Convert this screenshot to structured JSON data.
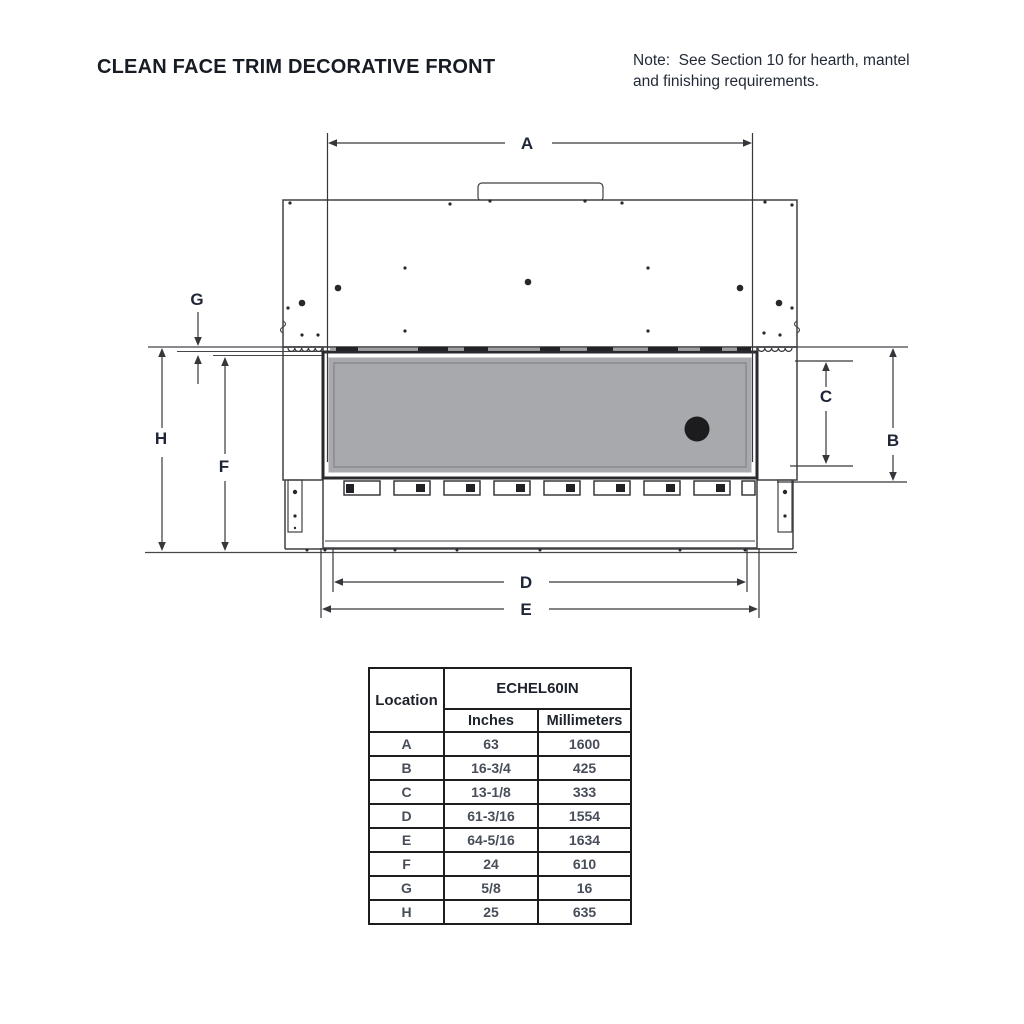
{
  "title": "CLEAN FACE TRIM DECORATIVE FRONT",
  "note": {
    "line1": "Note:  See Section 10 for hearth, mantel",
    "line2": "and finishing requirements."
  },
  "diagram": {
    "dim_labels": {
      "A": "A",
      "B": "B",
      "C": "C",
      "D": "D",
      "E": "E",
      "F": "F",
      "G": "G",
      "H": "H"
    },
    "colors": {
      "line": "#404044",
      "dimension_line": "#35373b",
      "glass_fill": "#a7a9ad",
      "label_text": "#1e2637"
    }
  },
  "spec_table": {
    "location_header": "Location",
    "model_header": "ECHEL60IN",
    "inches_header": "Inches",
    "mm_header": "Millimeters",
    "rows": [
      {
        "location": "A",
        "inches": "63",
        "mm": "1600"
      },
      {
        "location": "B",
        "inches": "16-3/4",
        "mm": "425"
      },
      {
        "location": "C",
        "inches": "13-1/8",
        "mm": "333"
      },
      {
        "location": "D",
        "inches": "61-3/16",
        "mm": "1554"
      },
      {
        "location": "E",
        "inches": "64-5/16",
        "mm": "1634"
      },
      {
        "location": "F",
        "inches": "24",
        "mm": "610"
      },
      {
        "location": "G",
        "inches": "5/8",
        "mm": "16"
      },
      {
        "location": "H",
        "inches": "25",
        "mm": "635"
      }
    ]
  }
}
